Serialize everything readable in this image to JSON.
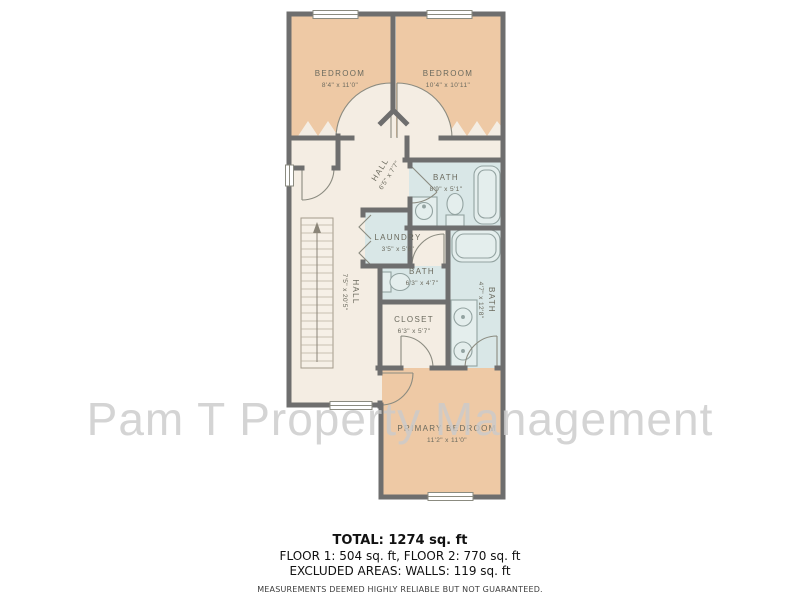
{
  "watermark": "Pam T Property Management",
  "plan": {
    "rooms": {
      "bedroom1": {
        "name": "BEDROOM",
        "dims": "8'4\" x 11'0\""
      },
      "bedroom2": {
        "name": "BEDROOM",
        "dims": "10'4\" x 10'11\""
      },
      "hall_upper": {
        "name": "HALL",
        "dims": "6'5\" x 7'7\""
      },
      "bath_top": {
        "name": "BATH",
        "dims": "8'9\" x 5'1\""
      },
      "laundry": {
        "name": "LAUNDRY",
        "dims": "3'5\" x 5'6\""
      },
      "bath_mid": {
        "name": "BATH",
        "dims": "6'3\" x 4'7\""
      },
      "bath_primary": {
        "name": "BATH",
        "dims": "4'7\" x 12'8\""
      },
      "closet": {
        "name": "CLOSET",
        "dims": "6'3\" x 5'7\""
      },
      "hall_lower": {
        "name": "HALL",
        "dims": "7'5\" x 20'5\""
      },
      "primary_bedroom": {
        "name": "PRIMARY BEDROOM",
        "dims": "11'2\" x 11'0\""
      }
    },
    "colors": {
      "wall": "#6e6e6e",
      "bedroom_floor": "#eec9a5",
      "hall_floor": "#f4ede3",
      "bath_floor": "#d9e7e7",
      "label_text": "#6b6a5e",
      "watermark_gray": "#cbcbcb"
    }
  },
  "footer": {
    "total": "TOTAL: 1274 sq. ft",
    "floors": "FLOOR 1: 504 sq. ft, FLOOR 2: 770 sq. ft",
    "excluded": "EXCLUDED AREAS: WALLS: 119 sq. ft",
    "disclaimer": "MEASUREMENTS DEEMED HIGHLY RELIABLE BUT NOT GUARANTEED."
  }
}
